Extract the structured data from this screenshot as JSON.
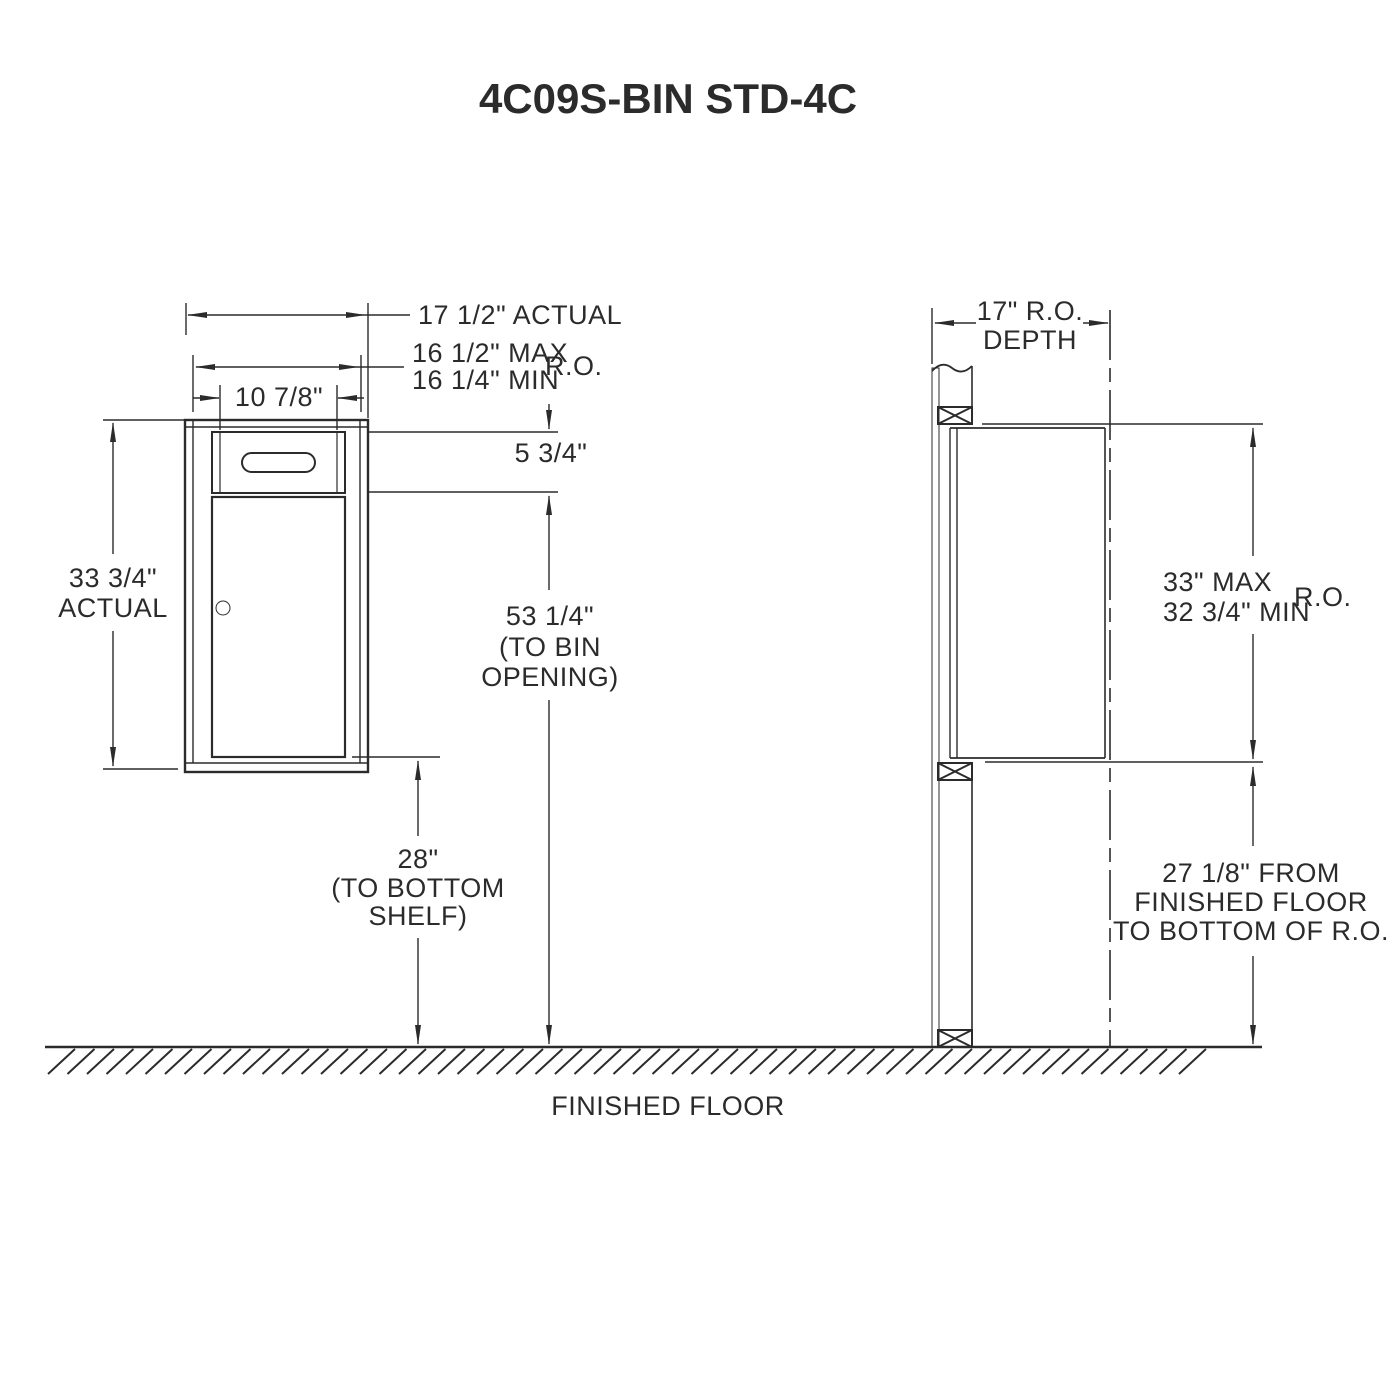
{
  "title": "4C09S-BIN STD-4C",
  "front_view": {
    "dim_width_actual": "17 1/2\" ACTUAL",
    "dim_width_ro_max": "16 1/2\" MAX",
    "dim_width_ro_min": "16 1/4\" MIN",
    "dim_width_ro_suffix": "R.O.",
    "dim_slot_width": "10 7/8\"",
    "dim_height_actual_line1": "33 3/4\"",
    "dim_height_actual_line2": "ACTUAL",
    "dim_opening_height": "5 3/4\"",
    "dim_bin_opening_line1": "53 1/4\"",
    "dim_bin_opening_line2": "(TO BIN",
    "dim_bin_opening_line3": "OPENING)",
    "dim_shelf_line1": "28\"",
    "dim_shelf_line2": "(TO BOTTOM",
    "dim_shelf_line3": "SHELF)"
  },
  "side_view": {
    "dim_depth_line1": "17\" R.O.",
    "dim_depth_line2": "DEPTH",
    "dim_ro_height_max": "33\" MAX",
    "dim_ro_height_min": "32 3/4\" MIN",
    "dim_ro_height_suffix": "R.O.",
    "dim_floor_line1": "27 1/8\" FROM",
    "dim_floor_line2": "FINISHED FLOOR",
    "dim_floor_line3": "TO BOTTOM OF R.O."
  },
  "floor_label": "FINISHED FLOOR",
  "colors": {
    "line": "#2b2b2b",
    "background": "#ffffff"
  }
}
